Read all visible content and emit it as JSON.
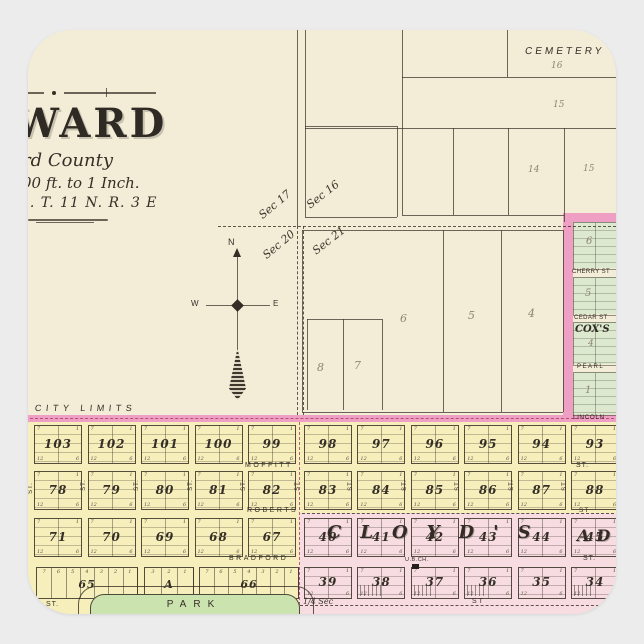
{
  "title_block": {
    "title": "WARD",
    "county": "rd County",
    "scale": "00 ft. to 1 Inch.",
    "township": "1. T. 11 N. R. 3 E"
  },
  "compass": {
    "n": "N",
    "w": "W",
    "e": "E"
  },
  "sections": {
    "nw": "Sec 17",
    "ne": "Sec 16",
    "sw": "Sec 20",
    "se": "Sec 21"
  },
  "cemetery": {
    "label": "CEMETERY",
    "p16": "16",
    "p15a": "15",
    "p14": "14",
    "p15b": "15"
  },
  "mid_parcels": {
    "b8": "8",
    "b7": "7",
    "b6": "6",
    "b5": "5",
    "b4": "4"
  },
  "cox": {
    "name": "COX'S",
    "streets": [
      "CHERRY ST",
      "CEDAR ST",
      "PEARL"
    ],
    "lincoln": "LINCOLN",
    "blocks": [
      "6",
      "5",
      "4",
      "1"
    ]
  },
  "city_limits": "CITY LIMITS",
  "rows": {
    "a": [
      "103",
      "102",
      "101",
      "100",
      "99",
      "98",
      "97",
      "96",
      "95",
      "94",
      "93"
    ],
    "b": [
      "78",
      "79",
      "80",
      "81",
      "82",
      "83",
      "84",
      "85",
      "86",
      "87",
      "88"
    ],
    "c": [
      "71",
      "70",
      "69",
      "68",
      "67",
      "40",
      "41",
      "42",
      "43",
      "44",
      "45"
    ],
    "d_right": [
      "39",
      "38",
      "37",
      "36",
      "35",
      "34"
    ]
  },
  "row_d_left": [
    {
      "label": "65",
      "lots": [
        "7",
        "6",
        "5",
        "4",
        "3",
        "2",
        "1"
      ]
    },
    {
      "label": "A",
      "lots": [
        "3",
        "2",
        "1"
      ]
    },
    {
      "label": "66",
      "lots": [
        "7",
        "6",
        "5",
        "4",
        "3",
        "2",
        "1"
      ]
    }
  ],
  "streets": {
    "moffitt": "MOFFITT",
    "roberts": "ROBERTS",
    "bradford": "BRADFORD",
    "st": "ST",
    "st_dot": "ST.",
    "quarter": "1/4 Sec"
  },
  "cloyds": {
    "name": "CLOYD'S",
    "name_cont": "AD",
    "church": "U.B.CH."
  },
  "park": "PARK",
  "lot_corners": {
    "tl": "7",
    "tr": "1",
    "bl": "12",
    "br": "6"
  },
  "colors": {
    "paper": "#f3edd7",
    "yellow": "#f6efbc",
    "pink_band": "#ee9fc3",
    "pink_fill": "#f7dde2",
    "green": "#dce9cf",
    "park_green": "#cbe3ae",
    "ink": "#473f35",
    "faint": "#8d8574"
  }
}
